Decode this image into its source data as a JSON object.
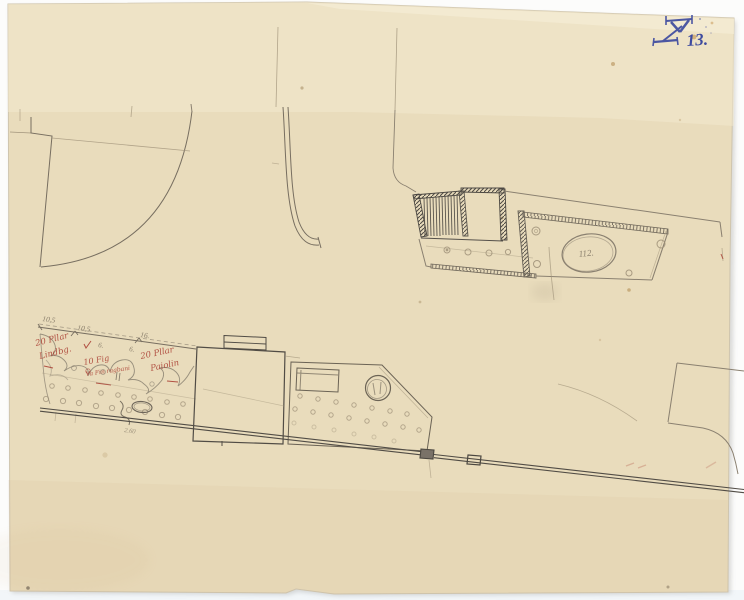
{
  "document": {
    "kind": "scanned archival site-plan pencil drawing on aged paper"
  },
  "stamp": {
    "mark": "blue-ink surveyor monogram",
    "number": "13.",
    "color": "#3e4b9f"
  },
  "measurements": {
    "d1": "10,5",
    "d2": "10,5",
    "d3": "16.",
    "d4": "6.",
    "d5": "6.",
    "oval_label": "112.",
    "length_note": "2.60"
  },
  "red_annotations": {
    "left_line1": "20 Pllar",
    "left_line2": "Lindbg.",
    "mid_line1": "10 Fig",
    "mid_line2": "Va Fin ragbani",
    "right_line1": "20 Pllar",
    "right_line2": "Paiolin"
  },
  "colors": {
    "background": "#fcfcfb",
    "paper": "#e9dcbc",
    "paper_light": "#f1e7cc",
    "ink_blue": "#3e4b9f",
    "ink_red": "#a8392e",
    "pencil": "#6f675a",
    "pencil_faint": "#a2957c",
    "line_dark": "#4b4740"
  }
}
